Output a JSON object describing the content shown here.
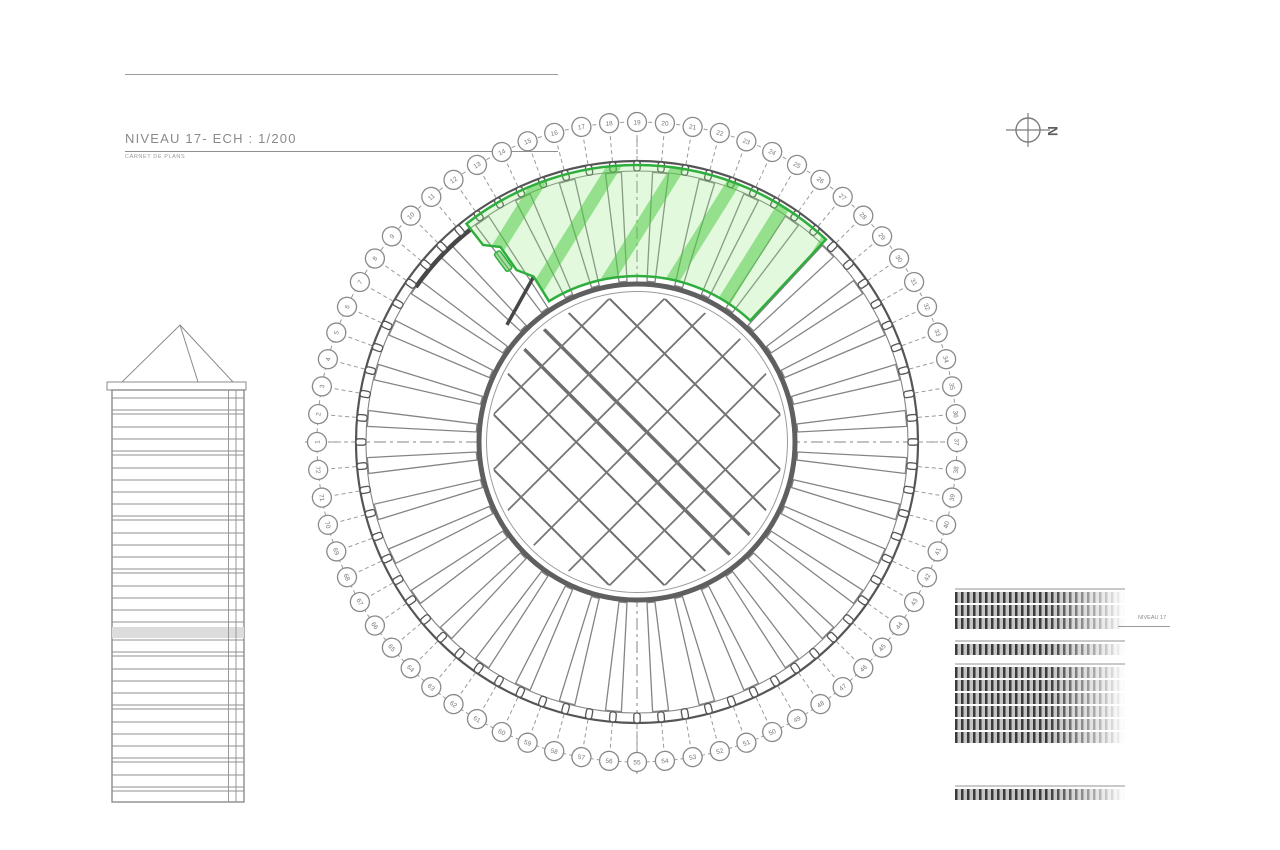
{
  "title_block": {
    "title": "NIVEAU 17- ECH : 1/200",
    "subtitle": "CARNET DE PLANS"
  },
  "north_arrow": {
    "label": "N"
  },
  "plan": {
    "grid_numbers": [
      1,
      2,
      3,
      4,
      5,
      6,
      7,
      8,
      9,
      10,
      11,
      12,
      13,
      14,
      15,
      16,
      17,
      18,
      19,
      20,
      21,
      22,
      23,
      24,
      25,
      26,
      27,
      28,
      29,
      30,
      31,
      32,
      33,
      34,
      35,
      36,
      37,
      38,
      39,
      40,
      41,
      42,
      43,
      44,
      45,
      46,
      47,
      48,
      49,
      50,
      51,
      52,
      53,
      54,
      55,
      56,
      57,
      58,
      59,
      60,
      61,
      62,
      63,
      64,
      65,
      66,
      67,
      68,
      69,
      70,
      71,
      72
    ],
    "top_grid_number": 19,
    "step_deg": 5,
    "center": {
      "x": 637,
      "y": 442
    },
    "radii": {
      "numbers": 320,
      "facade_outer": 281,
      "facade_inner": 271,
      "mullion": 276,
      "core_outer": 158,
      "core_inner": 150.5
    },
    "highlight": {
      "start_deg": -38,
      "end_deg": 43,
      "outer_r": 277,
      "inner_r": 166,
      "outline_color": "#2fae3e",
      "fill_color": "rgba(140,230,120,0.25)",
      "hatch_color": "rgba(70,200,60,0.5)"
    },
    "line_colors": {
      "light": "#9a9a9a",
      "mid": "#848484",
      "dark": "#555555",
      "heavy": "#474747"
    }
  },
  "tower_elevation": {
    "body": {
      "left": 112,
      "top": 390,
      "right": 244,
      "bottom": 802
    },
    "cap": {
      "left": 107,
      "top": 382,
      "right": 246,
      "bottom": 390
    },
    "apex": {
      "x": 180,
      "y": 325
    },
    "hip_x": 198,
    "vertical_lines": [
      228.5,
      236
    ],
    "gray_band": {
      "top": 627,
      "height": 11
    },
    "floor_lines": [
      398,
      410,
      414,
      427,
      439,
      451,
      455,
      468,
      480,
      492,
      504,
      516,
      520,
      533,
      545,
      557,
      569,
      573,
      586,
      598,
      610,
      622,
      640,
      652,
      656,
      669,
      681,
      693,
      705,
      709,
      722,
      734,
      746,
      758,
      762,
      775,
      787,
      791
    ]
  },
  "level_elevation": {
    "label": "NIVEAU 17",
    "strips_left": 955,
    "strip_width": 170,
    "band_height": 11,
    "groups": [
      {
        "top": 588,
        "bands": 3
      },
      {
        "top": 640,
        "bands": 1
      },
      {
        "top": 663,
        "bands": 6
      },
      {
        "top": 785,
        "bands": 1
      }
    ]
  }
}
